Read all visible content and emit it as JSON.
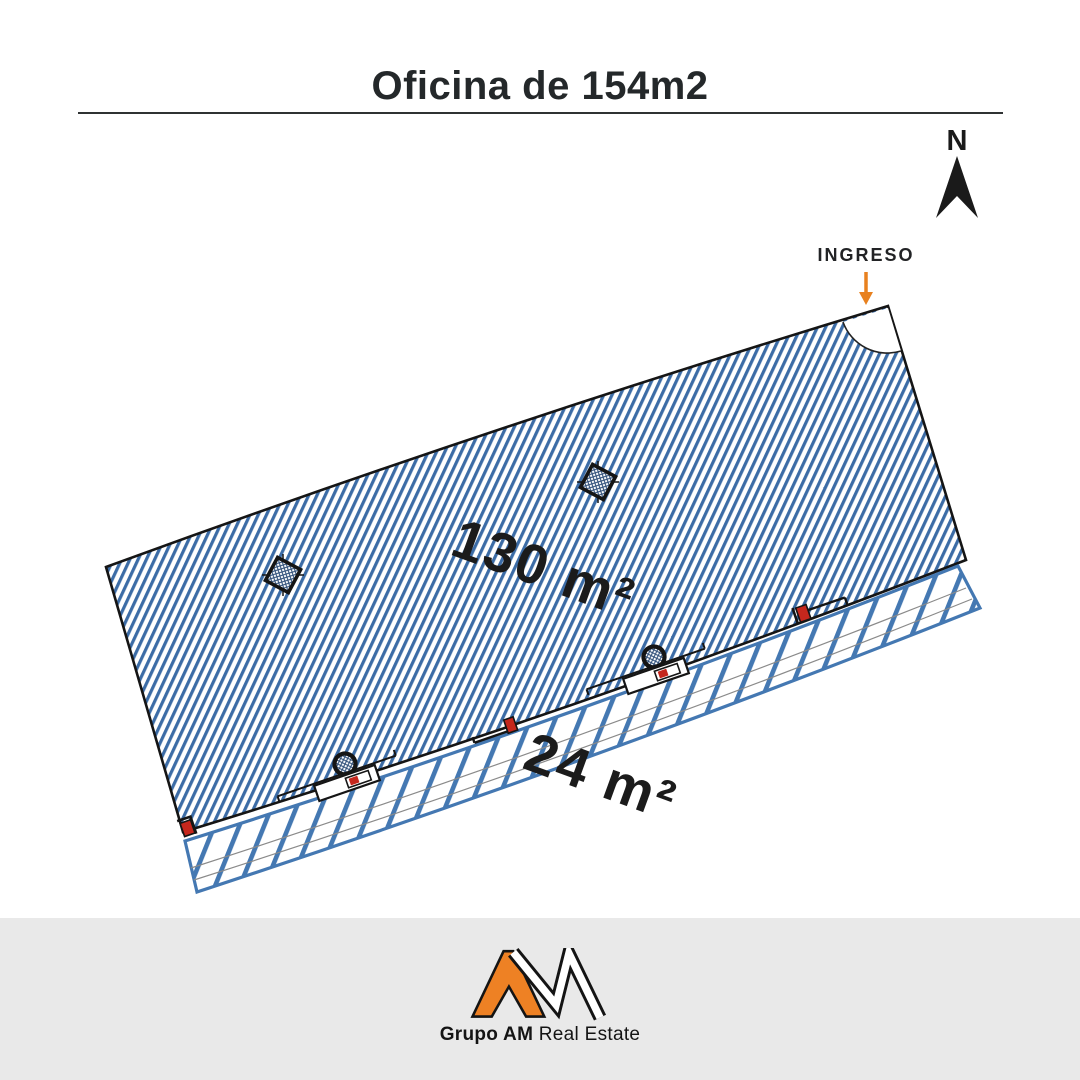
{
  "title": "Oficina de 154m2",
  "compass": {
    "label": "N"
  },
  "entrance": {
    "label": "INGRESO"
  },
  "plan": {
    "main_area_label": "130 m²",
    "strip_area_label": "24 m²",
    "colors": {
      "hatch_blue": "#3C6CA6",
      "strip_blue": "#4478B2",
      "outline": "#151515",
      "door_red": "#C5271D",
      "entrance_orange": "#E8811F"
    }
  },
  "footer": {
    "brand_bold": "Grupo AM",
    "brand_regular": " Real Estate",
    "logo_orange": "#EE8124"
  }
}
